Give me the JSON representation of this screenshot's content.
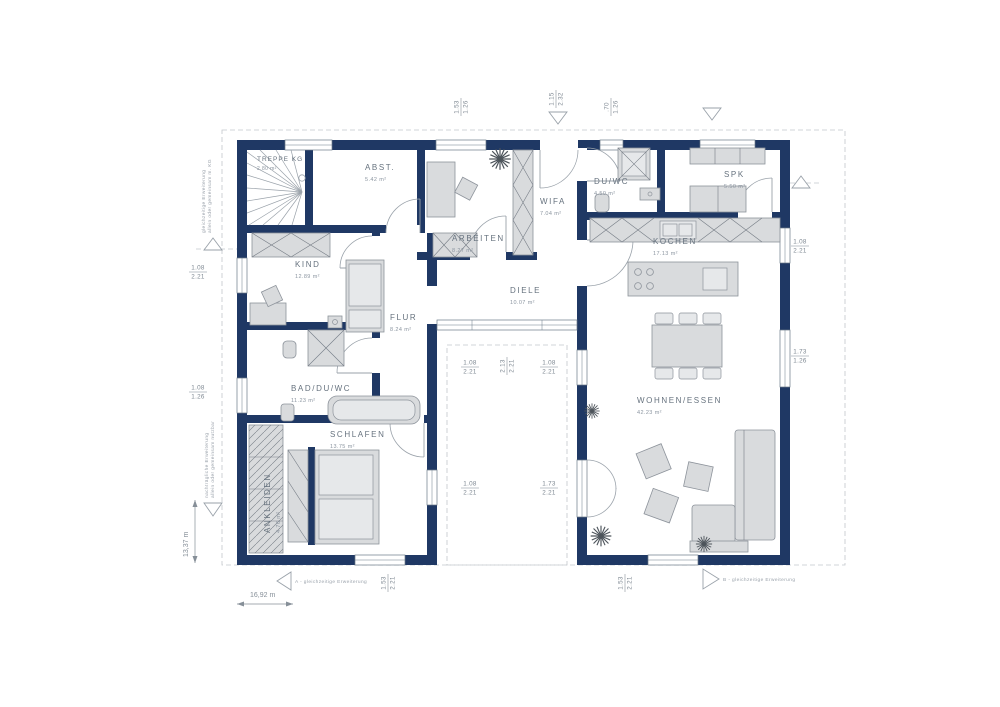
{
  "plan_title": "Erdgeschoss Grundriss",
  "colors": {
    "wall": "#1f3864",
    "furniture": "#d9dbdd",
    "furniture_stroke": "#8d939b",
    "room_text": "#66727e",
    "dim_text": "#7d8791",
    "dash": "#c3c7cb"
  },
  "rooms": {
    "treppe": {
      "name": "TREPPE KG",
      "area": "2.80 m²"
    },
    "abst": {
      "name": "ABST.",
      "area": "5.42 m²"
    },
    "arbeiten": {
      "name": "ARBEITEN",
      "area": "8.27 m²"
    },
    "wifa": {
      "name": "WIFA",
      "area": "7.04 m²"
    },
    "duwc": {
      "name": "DU/WC",
      "area": "4.50 m²"
    },
    "spk": {
      "name": "SPK",
      "area": "5.50 m²"
    },
    "kochen": {
      "name": "KOCHEN",
      "area": "17.13 m²"
    },
    "kind": {
      "name": "KIND",
      "area": "12.89 m²"
    },
    "flur": {
      "name": "FLUR",
      "area": "8.24 m²"
    },
    "diele": {
      "name": "DIELE",
      "area": "10.07 m²"
    },
    "bad": {
      "name": "BAD/DU/WC",
      "area": "11.23 m²"
    },
    "schlafen": {
      "name": "SCHLAFEN",
      "area": "13.75 m²"
    },
    "ankleiden": {
      "name": "ANKLEIDEN",
      "area": "4.76 m²"
    },
    "wohnen": {
      "name": "WOHNEN/ESSEN",
      "area": "42.23 m²"
    }
  },
  "dims": {
    "t1": {
      "w": "1.53",
      "h": "1.26"
    },
    "t2": {
      "w": "1.15",
      "h": "2.32"
    },
    "t3": {
      "w": ".70",
      "h": "1.26"
    },
    "r1": {
      "w": "1.08",
      "h": "2.21"
    },
    "r2": {
      "w": "1.73",
      "h": "1.26"
    },
    "l1": {
      "w": "1.08",
      "h": "2.21"
    },
    "l2": {
      "w": "1.08",
      "h": "1.26"
    },
    "c1": {
      "w": "1.08",
      "h": "2.21"
    },
    "c2": {
      "w": "2.13",
      "h": "2.21"
    },
    "c3": {
      "w": "1.08",
      "h": "2.21"
    },
    "c4": {
      "w": "1.08",
      "h": "2.21"
    },
    "c5": {
      "w": "1.73",
      "h": "2.21"
    },
    "b1": {
      "w": "1.53",
      "h": "2.21"
    },
    "b2": {
      "w": "1.53",
      "h": "2.21"
    }
  },
  "scale": {
    "width_label": "16,92 m",
    "height_label": "13,37 m"
  },
  "annotations": {
    "a": "A - gleichzeitige Erweiterung",
    "b": "B - gleichzeitige Erweiterung",
    "left_top_1": "gleichzeitige Erweiterung",
    "left_top_2": "allein oder gemeinsam m. KG",
    "left_bottom_1": "nachträgliche Erweiterung",
    "left_bottom_2": "allein oder gemeinsam nutzbar"
  }
}
